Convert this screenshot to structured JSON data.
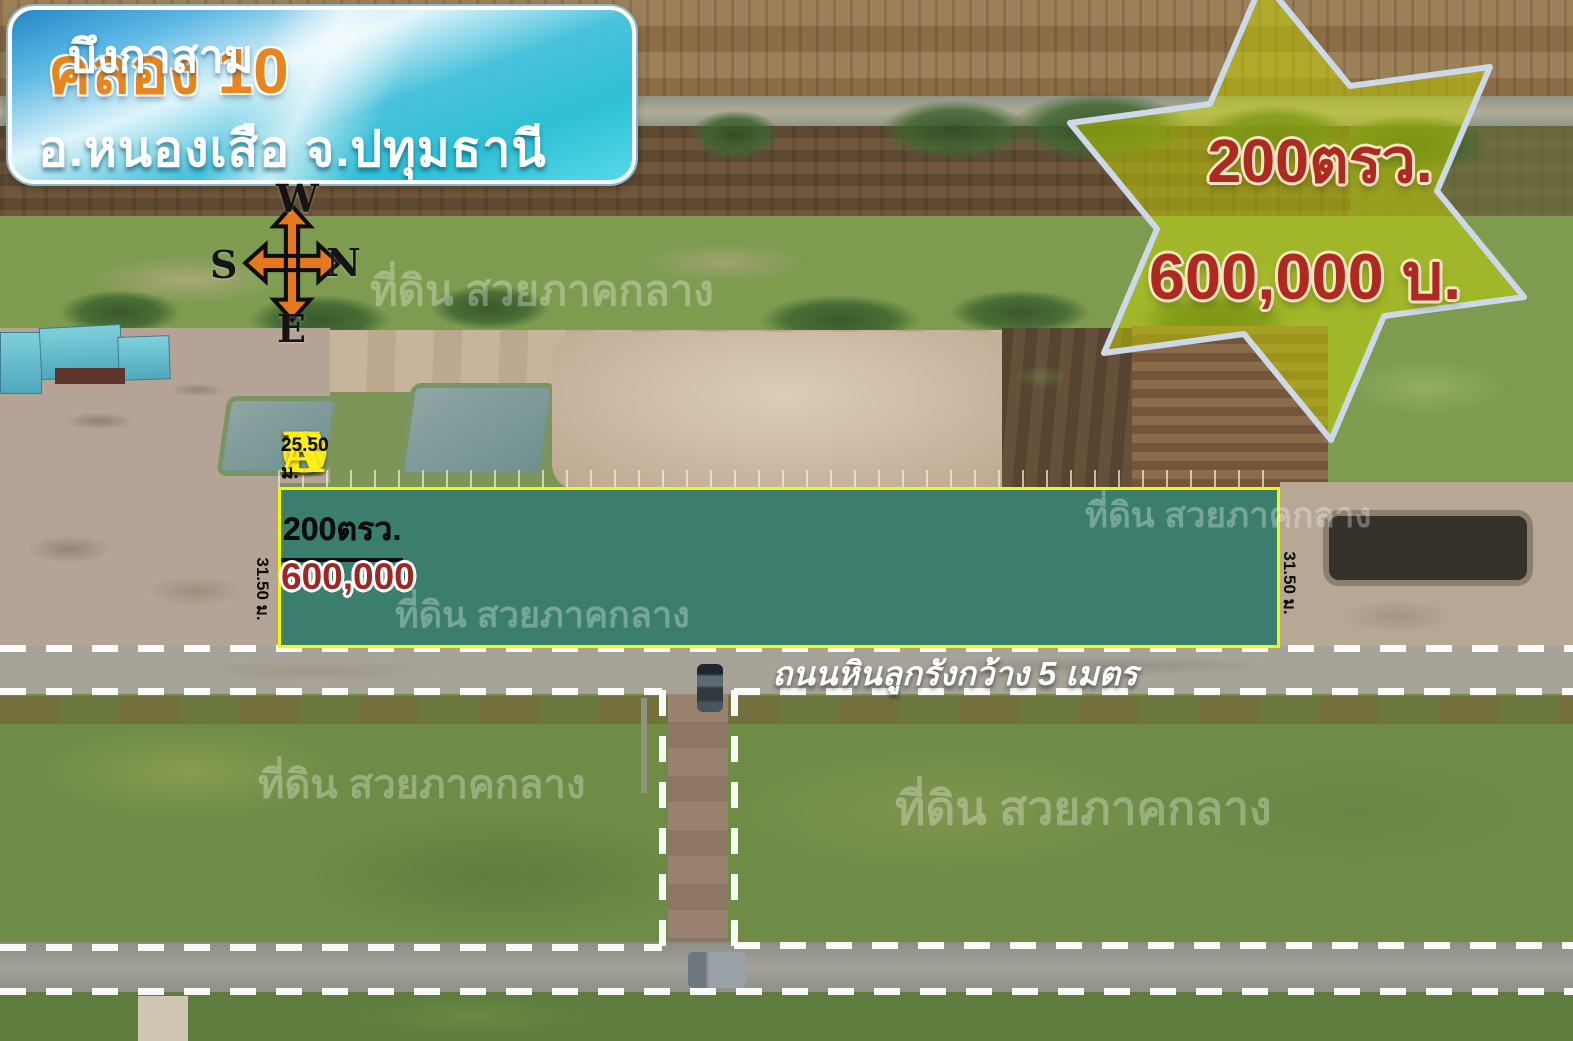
{
  "banner": {
    "title_highlight": "คลอง 10",
    "title_rest": "บึงกาสาม",
    "subtitle": "อ.หนองเสือ จ.ปทุมธานี"
  },
  "compass": {
    "top": "W",
    "right": "N",
    "left": "S",
    "bottom": "E"
  },
  "price_star": {
    "area": "200ตรว.",
    "price": "600,000 บ."
  },
  "plots": {
    "depth_label": "31.50 ม.",
    "items": [
      {
        "letter": "F",
        "area": "200ตรว.",
        "price": "600,000",
        "width": "25.50 ม."
      },
      {
        "letter": "E",
        "area": "200ตรว.",
        "price": "600,000",
        "width": "25.50 ม."
      },
      {
        "letter": "D",
        "area": "200ตรว.",
        "price": "600,000",
        "width": "25.50 ม."
      },
      {
        "letter": "C",
        "area": "200ตรว.",
        "price": "600,000",
        "width": "25.50 ม."
      },
      {
        "letter": "B",
        "area": "200ตรว.",
        "price": "600,000",
        "width": "25.50 ม."
      },
      {
        "letter": "A",
        "area": "200ตรว.",
        "price": "600,000",
        "width": "25.50 ม."
      }
    ]
  },
  "road": {
    "label": "ถนนหินลูกรังกว้าง 5 เมตร"
  },
  "watermark": {
    "text": "ที่ดิน สวยภาคกลาง"
  },
  "colors": {
    "plot_fill": "#0e6e80",
    "plot_border": "#f0fa00",
    "price_red": "#9e2723",
    "letter_yellow": "#ffef18",
    "banner_orange": "#e8851f",
    "banner_blue": "#49c2dc",
    "star_fill": "#c4d200",
    "star_border": "#cdd9e8",
    "compass_orange": "#e5781e"
  }
}
